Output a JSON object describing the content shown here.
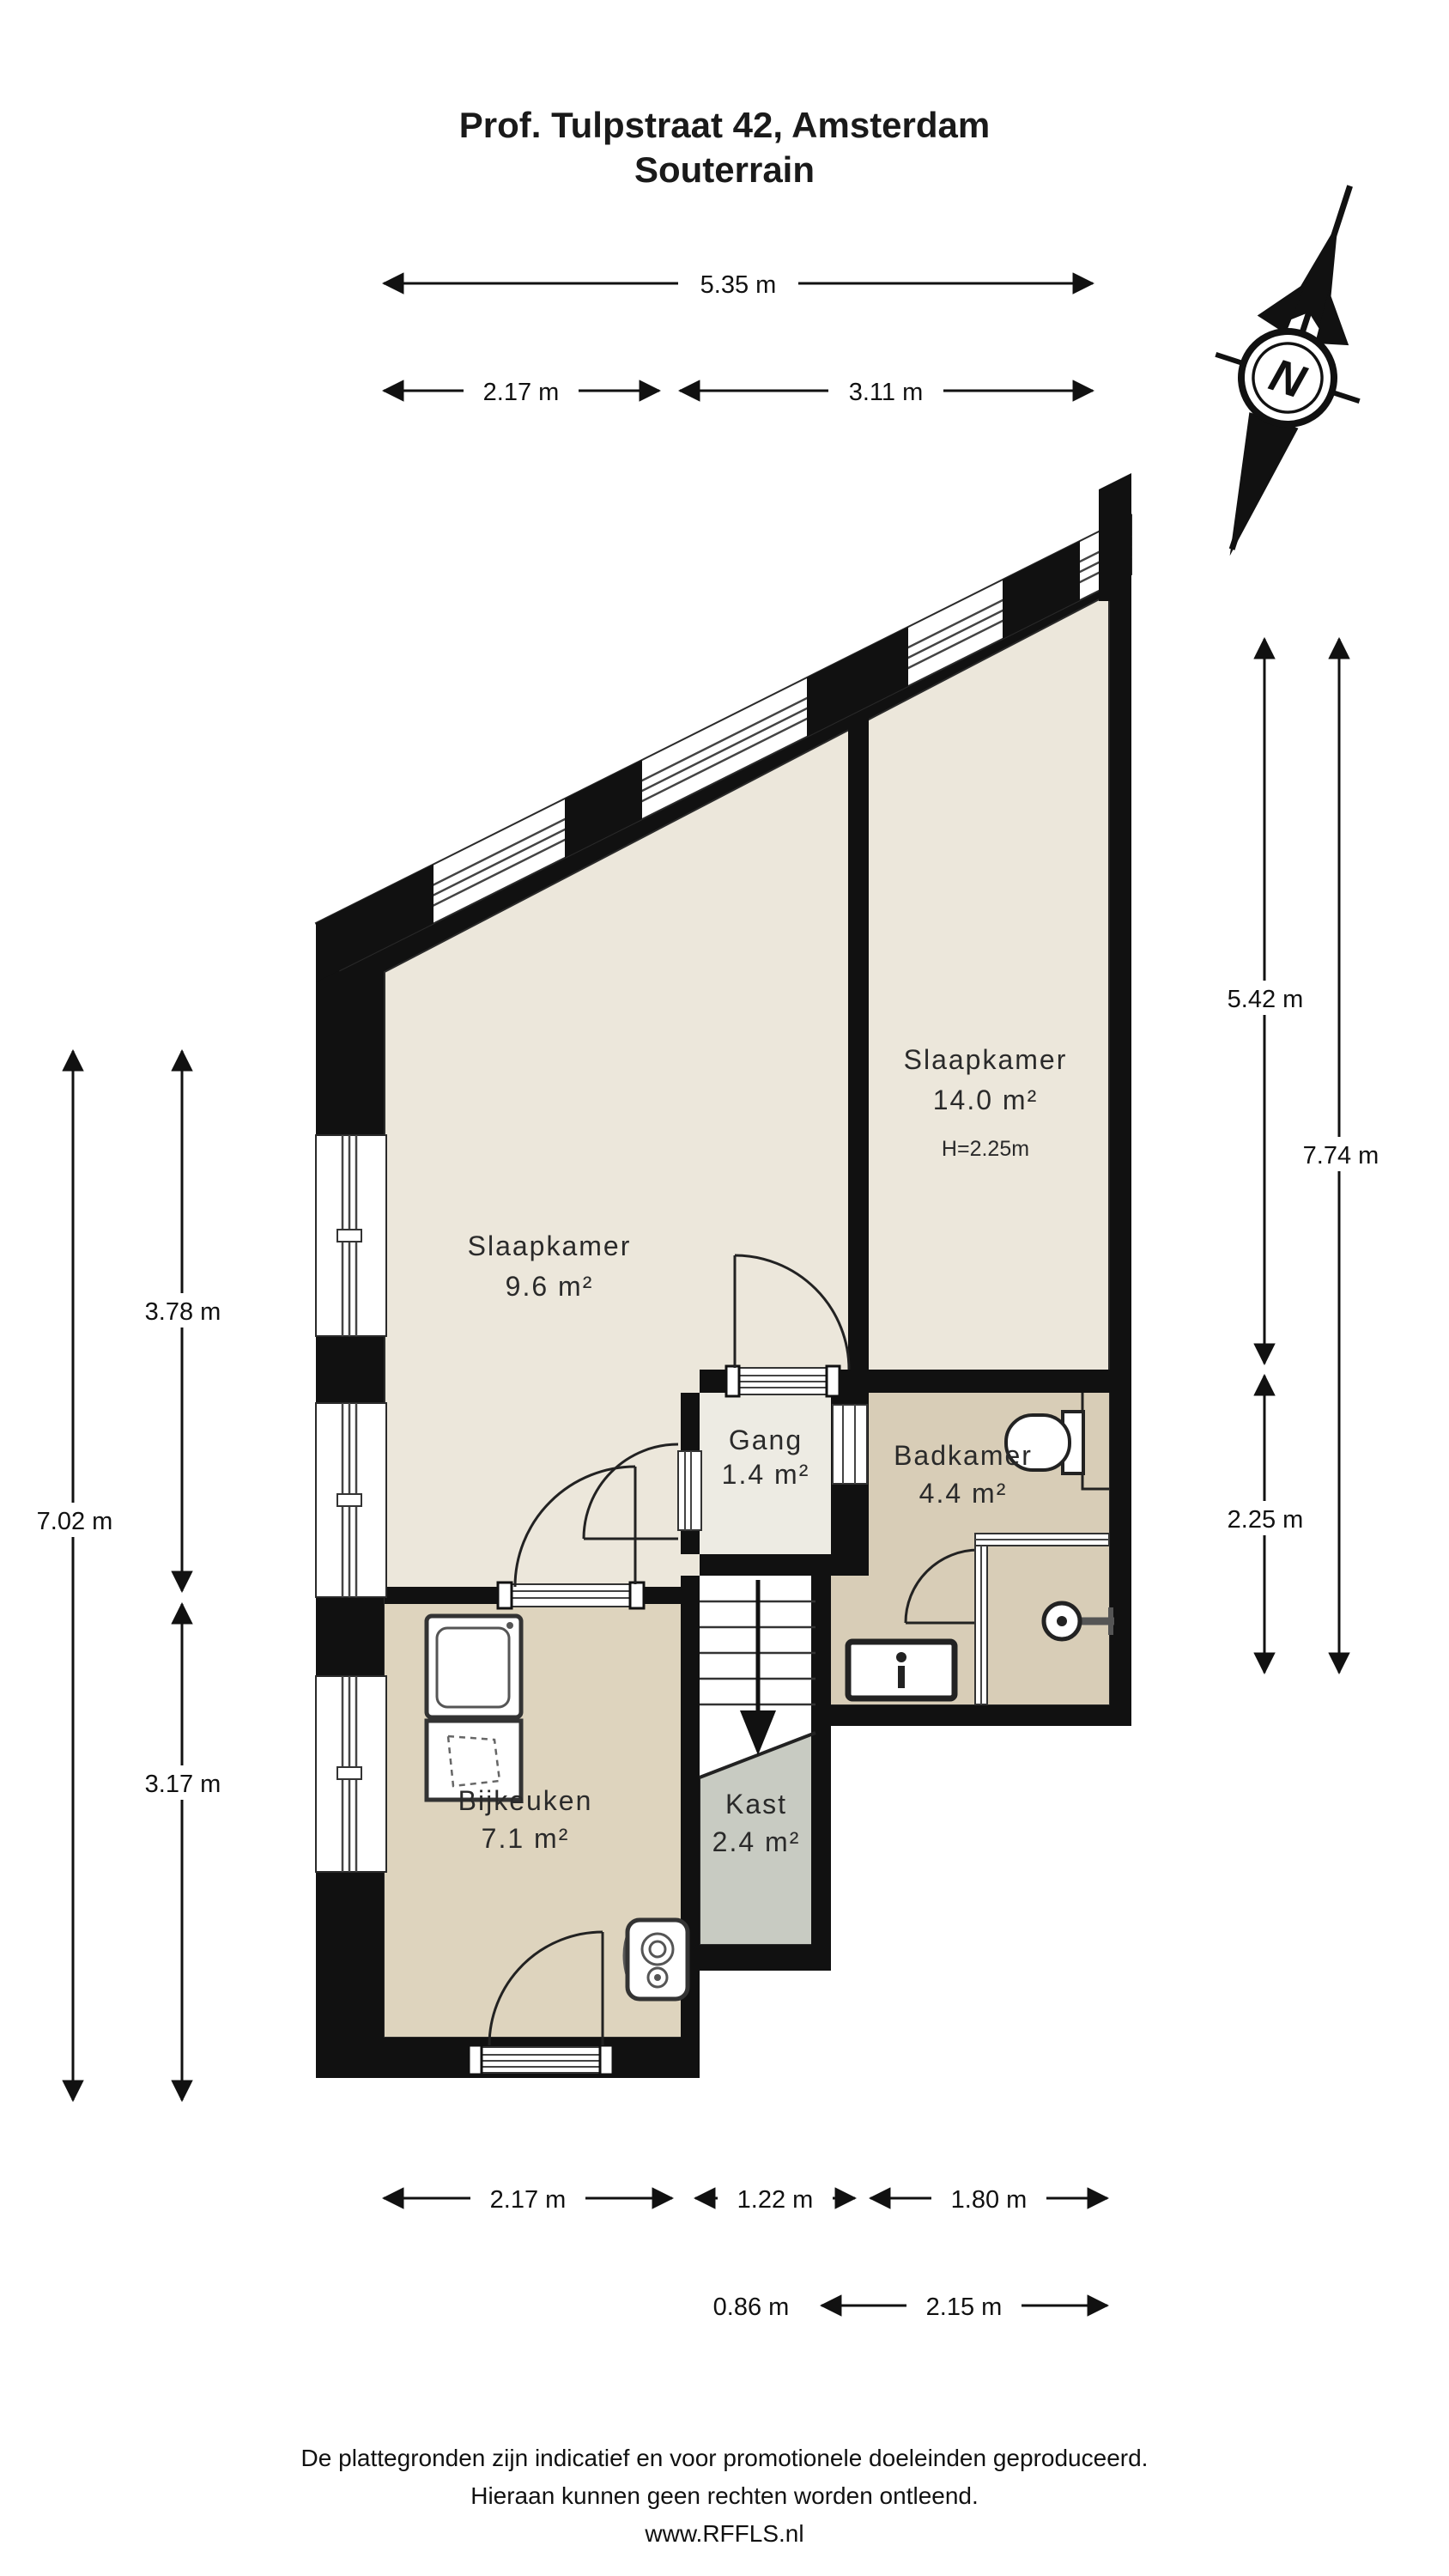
{
  "title": {
    "line1": "Prof. Tulpstraat 42, Amsterdam",
    "line2": "Souterrain"
  },
  "compass": {
    "north_label": "N"
  },
  "rooms": {
    "slaapkamer_large": {
      "name": "Slaapkamer",
      "area": "14.0 m²",
      "height_note": "H=2.25m"
    },
    "slaapkamer_small": {
      "name": "Slaapkamer",
      "area": "9.6 m²"
    },
    "gang": {
      "name": "Gang",
      "area": "1.4 m²"
    },
    "badkamer": {
      "name": "Badkamer",
      "area": "4.4 m²"
    },
    "bijkeuken": {
      "name": "Bijkeuken",
      "area": "7.1 m²"
    },
    "kast": {
      "name": "Kast",
      "area": "2.4 m²"
    }
  },
  "dimensions": {
    "top_total": "5.35 m",
    "top_left": "2.17 m",
    "top_right": "3.11 m",
    "left_total": "7.02 m",
    "left_upper": "3.78 m",
    "left_lower": "3.17 m",
    "right_total": "7.74 m",
    "right_upper": "5.42 m",
    "right_lower": "2.25 m",
    "bottom_left": "2.17 m",
    "bottom_middle": "1.22 m",
    "bottom_right": "1.80 m",
    "bottom2_left": "0.86 m",
    "bottom2_right": "2.15 m"
  },
  "footer": {
    "line1": "De plattegronden zijn indicatief en voor promotionele doeleinden geproduceerd.",
    "line2": "Hieraan kunnen geen rechten worden ontleend.",
    "line3": "www.RFFLS.nl"
  },
  "colors": {
    "wall": "#111111",
    "bedroom_floor": "#ECE7DB",
    "gang_floor": "#EDEBE3",
    "badkamer_floor": "#D8CDB7",
    "bijkeuken_floor": "#DED4BE",
    "kast_floor": "#C8CBC2",
    "background": "#FFFFFF"
  }
}
